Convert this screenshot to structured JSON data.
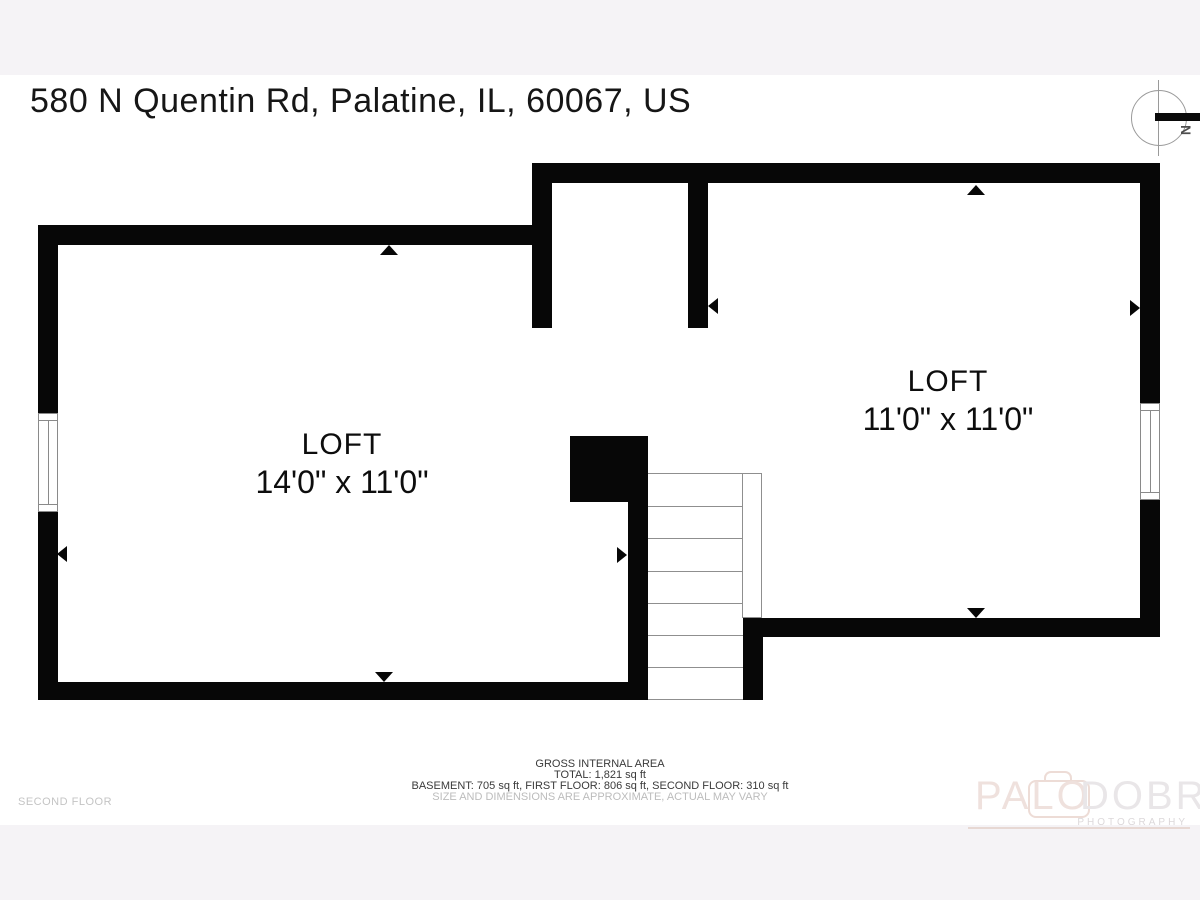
{
  "page": {
    "title": "580 N Quentin Rd, Palatine, IL, 60067, US",
    "floor_label": "SECOND FLOOR"
  },
  "compass": {
    "label": "N"
  },
  "rooms": [
    {
      "name": "LOFT",
      "dimensions": "14'0\" x 11'0\""
    },
    {
      "name": "LOFT",
      "dimensions": "11'0\" x 11'0\""
    }
  ],
  "footer": {
    "area_title": "GROSS INTERNAL AREA",
    "total": "TOTAL: 1,821 sq ft",
    "breakdown": "BASEMENT: 705 sq ft, FIRST FLOOR: 806 sq ft, SECOND FLOOR: 310 sq ft",
    "disclaimer": "SIZE AND DIMENSIONS ARE APPROXIMATE, ACTUAL MAY VARY"
  },
  "watermark": {
    "brand_first": "PALO",
    "brand_second": "DOBRIK",
    "subtitle": "PHOTOGRAPHY"
  },
  "colors": {
    "wall": "#070707",
    "band_background": "#f5f3f6",
    "canvas": "#ffffff",
    "watermark_pink": "#efe1dd",
    "watermark_gray": "#e9e6e8",
    "muted_text": "#bcbcbc"
  }
}
